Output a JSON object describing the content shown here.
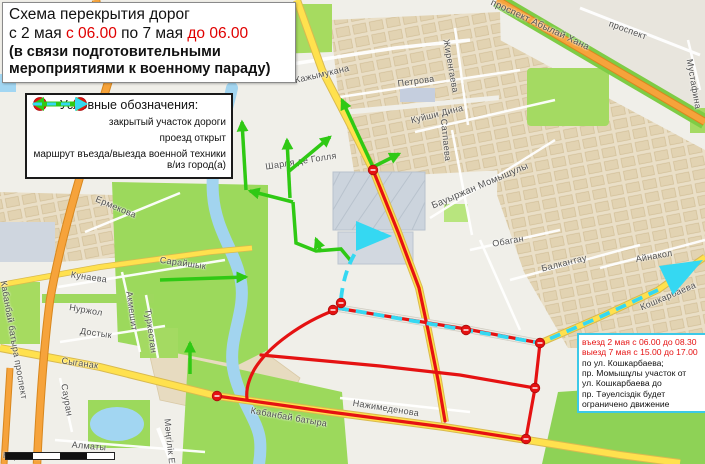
{
  "title": {
    "line1": "Схема перекрытия дорог",
    "line2_a": "с 2 мая ",
    "line2_b": "с 06.00",
    "line2_c": " по 7 мая ",
    "line2_d": " до 06.00",
    "line3": "(в связи подготовительными",
    "line4": "мероприятиями к военному параду)"
  },
  "legend": {
    "title": "Условные обозначения:",
    "stop_text": "STOP",
    "items": [
      {
        "label": "закрытый участок дороги",
        "type": "closed-road"
      },
      {
        "label": "проезд открыт",
        "type": "open-road"
      },
      {
        "label": "маршрут въезда/выезда военной техники в/из город(а)",
        "type": "military-route"
      }
    ]
  },
  "notice": {
    "lines": [
      {
        "text": "въезд 2 мая с 06.00 до 08.30",
        "color": "red"
      },
      {
        "text": "выезд 7 мая с 15.00 до 17.00",
        "color": "red"
      },
      {
        "text": "по ул. Кошкарбаева;",
        "color": "black"
      },
      {
        "text": "пр. Момышұлы участок от",
        "color": "black"
      },
      {
        "text": "ул. Кошкарбаева до",
        "color": "black"
      },
      {
        "text": "пр. Тәуелсіздік будет",
        "color": "black"
      },
      {
        "text": "ограничено движение",
        "color": "black"
      }
    ]
  },
  "map": {
    "colors": {
      "closed_route": "#e51212",
      "open_route": "#2fc914",
      "military_route": "#35d8f2",
      "main_road_orange": "#f6a33b",
      "road_yellow": "#ffe14e",
      "park_green": "#9cd95c",
      "water_blue": "#a2d4ef"
    },
    "street_labels": [
      {
        "text": "Кажымукана",
        "x": 322,
        "y": 74,
        "r": -13
      },
      {
        "text": "Петрова",
        "x": 416,
        "y": 81,
        "r": -8
      },
      {
        "text": "Жиренгаева",
        "x": 451,
        "y": 66,
        "r": 80
      },
      {
        "text": "Куйши Дина",
        "x": 437,
        "y": 114,
        "r": -14
      },
      {
        "text": "Сатпаева",
        "x": 446,
        "y": 140,
        "r": 84
      },
      {
        "text": "проспект Абылай Хана",
        "x": 540,
        "y": 25,
        "r": 25,
        "s": 9.5
      },
      {
        "text": "проспект",
        "x": 628,
        "y": 30,
        "r": 20
      },
      {
        "text": "Мустафина",
        "x": 694,
        "y": 84,
        "r": 80
      },
      {
        "text": "Бауыржан Момышулы",
        "x": 480,
        "y": 186,
        "r": -23,
        "s": 9.5
      },
      {
        "text": "Обаган",
        "x": 508,
        "y": 241,
        "r": -10
      },
      {
        "text": "Балкантау",
        "x": 564,
        "y": 263,
        "r": -14
      },
      {
        "text": "Айнакол",
        "x": 654,
        "y": 256,
        "r": -10
      },
      {
        "text": "Кошкарбаева",
        "x": 668,
        "y": 296,
        "r": -23
      },
      {
        "text": "Ермекова",
        "x": 116,
        "y": 207,
        "r": 23
      },
      {
        "text": "Кунаева",
        "x": 89,
        "y": 277,
        "r": 8
      },
      {
        "text": "Нуржол",
        "x": 86,
        "y": 310,
        "r": 10
      },
      {
        "text": "Достык",
        "x": 96,
        "y": 333,
        "r": 8
      },
      {
        "text": "Акмешит",
        "x": 132,
        "y": 311,
        "r": 82
      },
      {
        "text": "Туркестан",
        "x": 151,
        "y": 331,
        "r": 82
      },
      {
        "text": "Сарайшык",
        "x": 183,
        "y": 263,
        "r": 8
      },
      {
        "text": "Кабанбай батыра проспект",
        "x": 14,
        "y": 340,
        "r": 80
      },
      {
        "text": "Сыганак",
        "x": 80,
        "y": 363,
        "r": 8
      },
      {
        "text": "Сауран",
        "x": 67,
        "y": 400,
        "r": 80
      },
      {
        "text": "Алматы",
        "x": 89,
        "y": 446,
        "r": 5
      },
      {
        "text": "Керей Ж",
        "x": 22,
        "y": 456,
        "r": 3
      },
      {
        "text": "Мәңгілік Ел",
        "x": 170,
        "y": 444,
        "r": 84
      },
      {
        "text": "Нажимеденова",
        "x": 386,
        "y": 408,
        "r": 9
      },
      {
        "text": "Кабанбай батыра",
        "x": 289,
        "y": 417,
        "r": 10
      },
      {
        "text": "Шарля де Голля",
        "x": 301,
        "y": 161,
        "r": -9
      }
    ]
  }
}
